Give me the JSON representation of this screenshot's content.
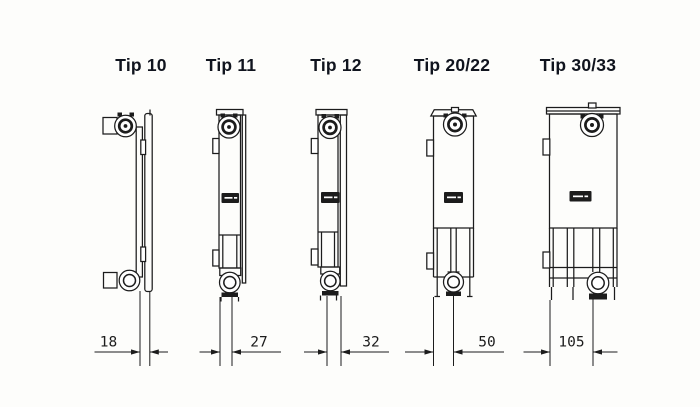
{
  "diagram": {
    "description_visible_text_only": "",
    "types": [
      {
        "id": "tip-10",
        "label": "Tip 10",
        "depth": "18"
      },
      {
        "id": "tip-11",
        "label": "Tip 11",
        "depth": "27"
      },
      {
        "id": "tip-12",
        "label": "Tip 12",
        "depth": "32"
      },
      {
        "id": "tip-2022",
        "label": "Tip 20/22",
        "depth": "50"
      },
      {
        "id": "tip-3033",
        "label": "Tip 30/33",
        "depth": "105"
      }
    ],
    "colors": {
      "line": "#1c1c1c",
      "label_text": "#10141e",
      "background": "#fdfdfb"
    }
  }
}
